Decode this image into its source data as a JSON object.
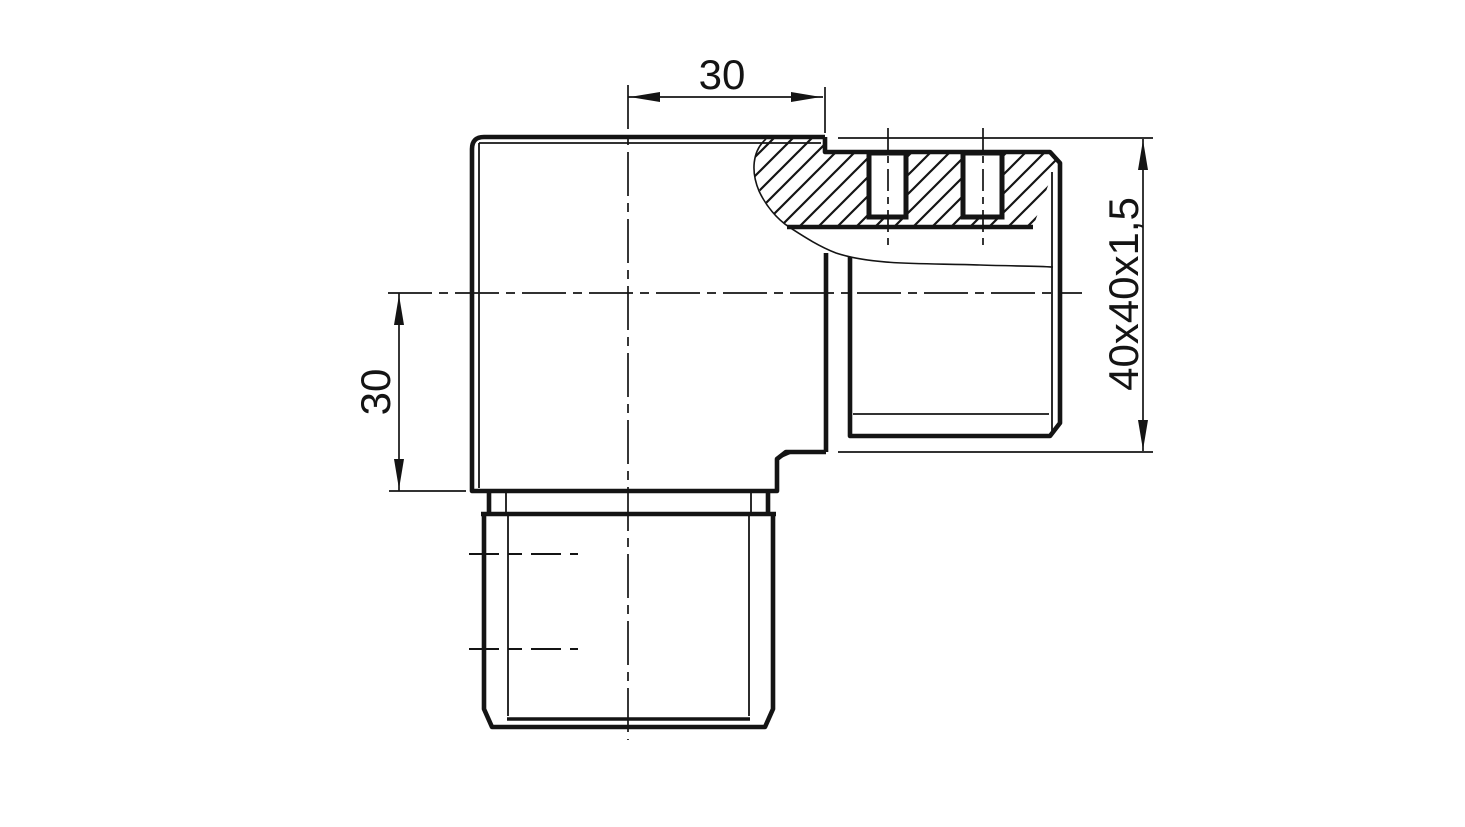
{
  "drawing": {
    "kind": "engineering-drawing",
    "dimensions": {
      "top": {
        "label": "30"
      },
      "left": {
        "label": "30"
      },
      "right": {
        "label": "40x40x1,5"
      }
    },
    "colors": {
      "line": "#141414",
      "background": "#ffffff"
    }
  }
}
